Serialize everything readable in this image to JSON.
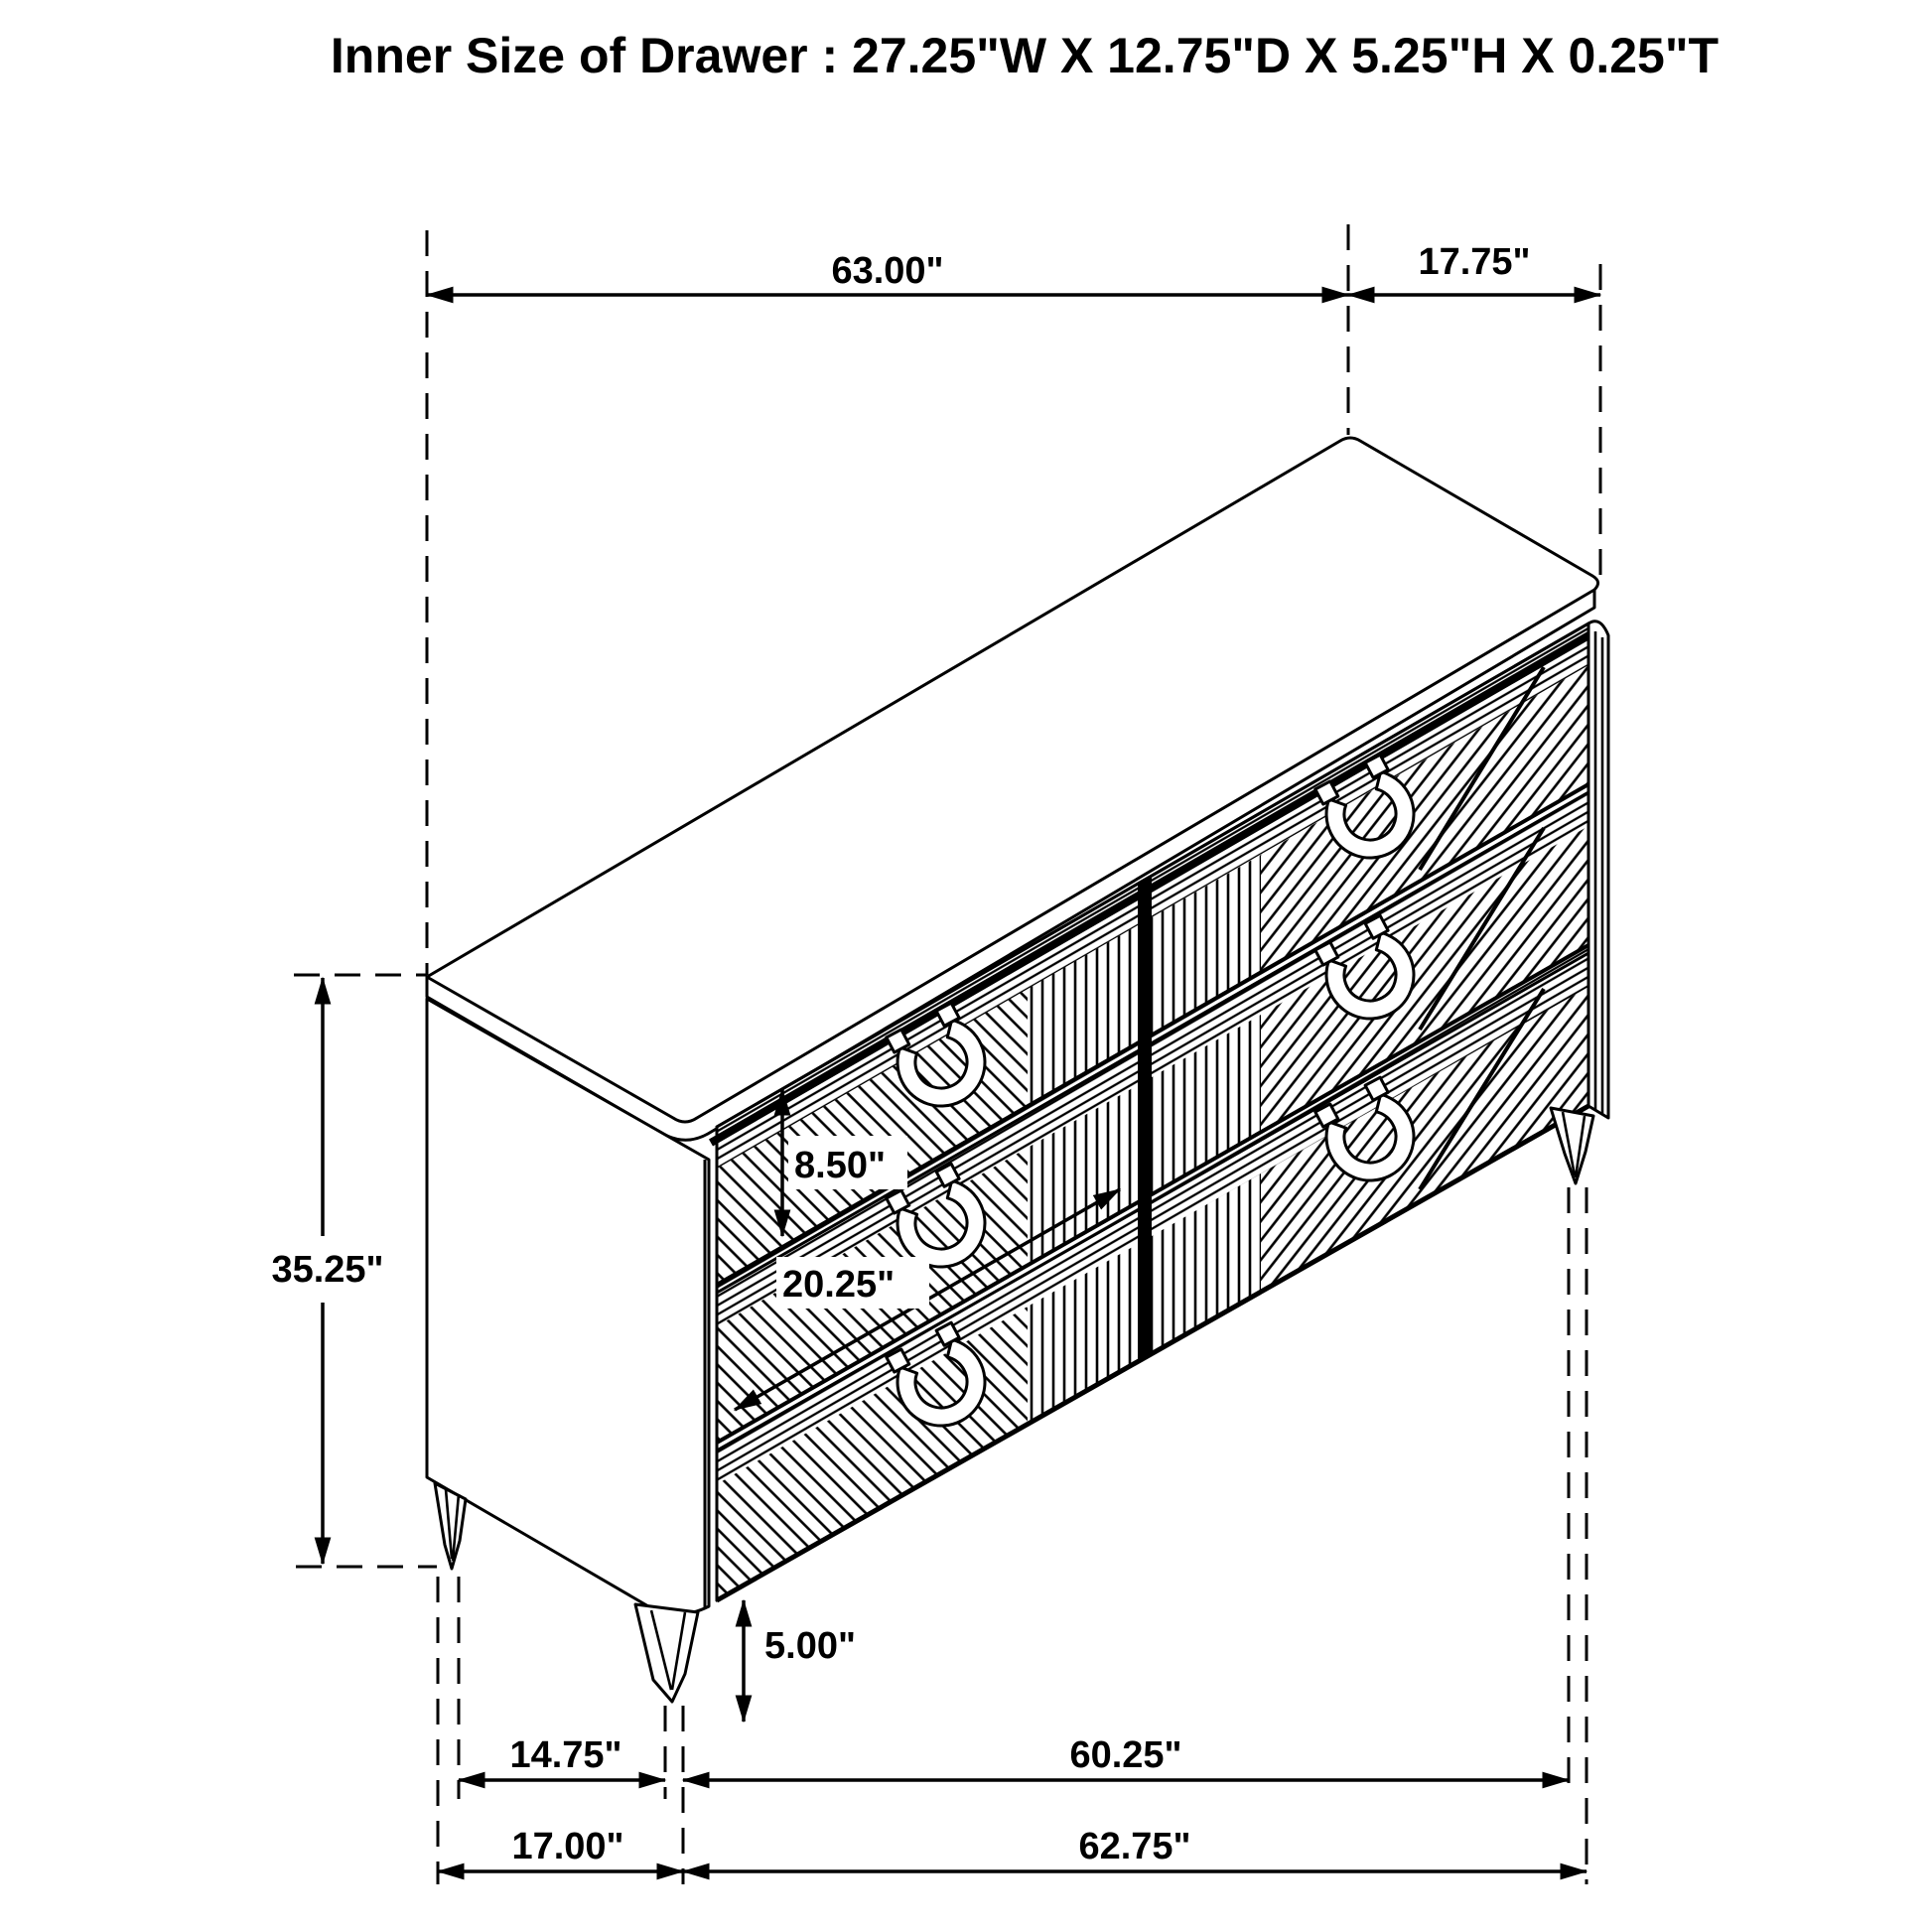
{
  "title": "Inner Size of Drawer : 27.25\"W X 12.75\"D X 5.25\"H X 0.25\"T",
  "diagram": {
    "labels": {
      "overall_width": "63.00\"",
      "top_depth": "17.75\"",
      "overall_height": "35.25\"",
      "drawer_opening_height": "8.50\"",
      "drawer_inner_depth": "20.25\"",
      "leg_height": "5.00\"",
      "front_leg_inset_depth": "14.75\"",
      "leg_span_width_inner": "60.25\"",
      "floor_depth_outer": "17.00\"",
      "floor_width_outer": "62.75\""
    },
    "colors": {
      "line": "#000000",
      "background": "#ffffff"
    }
  }
}
